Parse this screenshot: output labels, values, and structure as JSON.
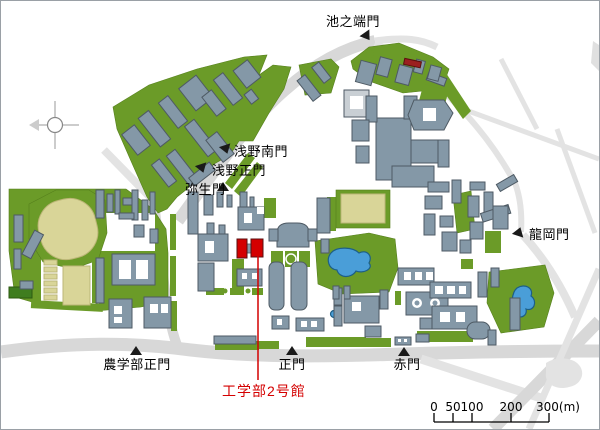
{
  "map": {
    "gates": {
      "ikenohata": "池之端門",
      "asano_south": "浅野南門",
      "asano_main": "浅野正門",
      "yayoi": "弥生門",
      "tatsuoka": "龍岡門",
      "nogakubu_main": "農学部正門",
      "main": "正門",
      "akamon": "赤門"
    },
    "highlight": {
      "label": "工学部2号館"
    },
    "scale_bar": {
      "t0": "0",
      "t50": "50",
      "t100": "100",
      "t200": "200",
      "t300": "300(m)"
    }
  },
  "colors": {
    "campus-green": "#6b9b28",
    "building": "#8498a7",
    "road": "#d8d8d8",
    "field-tan": "#d9d598",
    "pond-blue": "#4a9ed8",
    "highlight-red": "#d40000"
  }
}
